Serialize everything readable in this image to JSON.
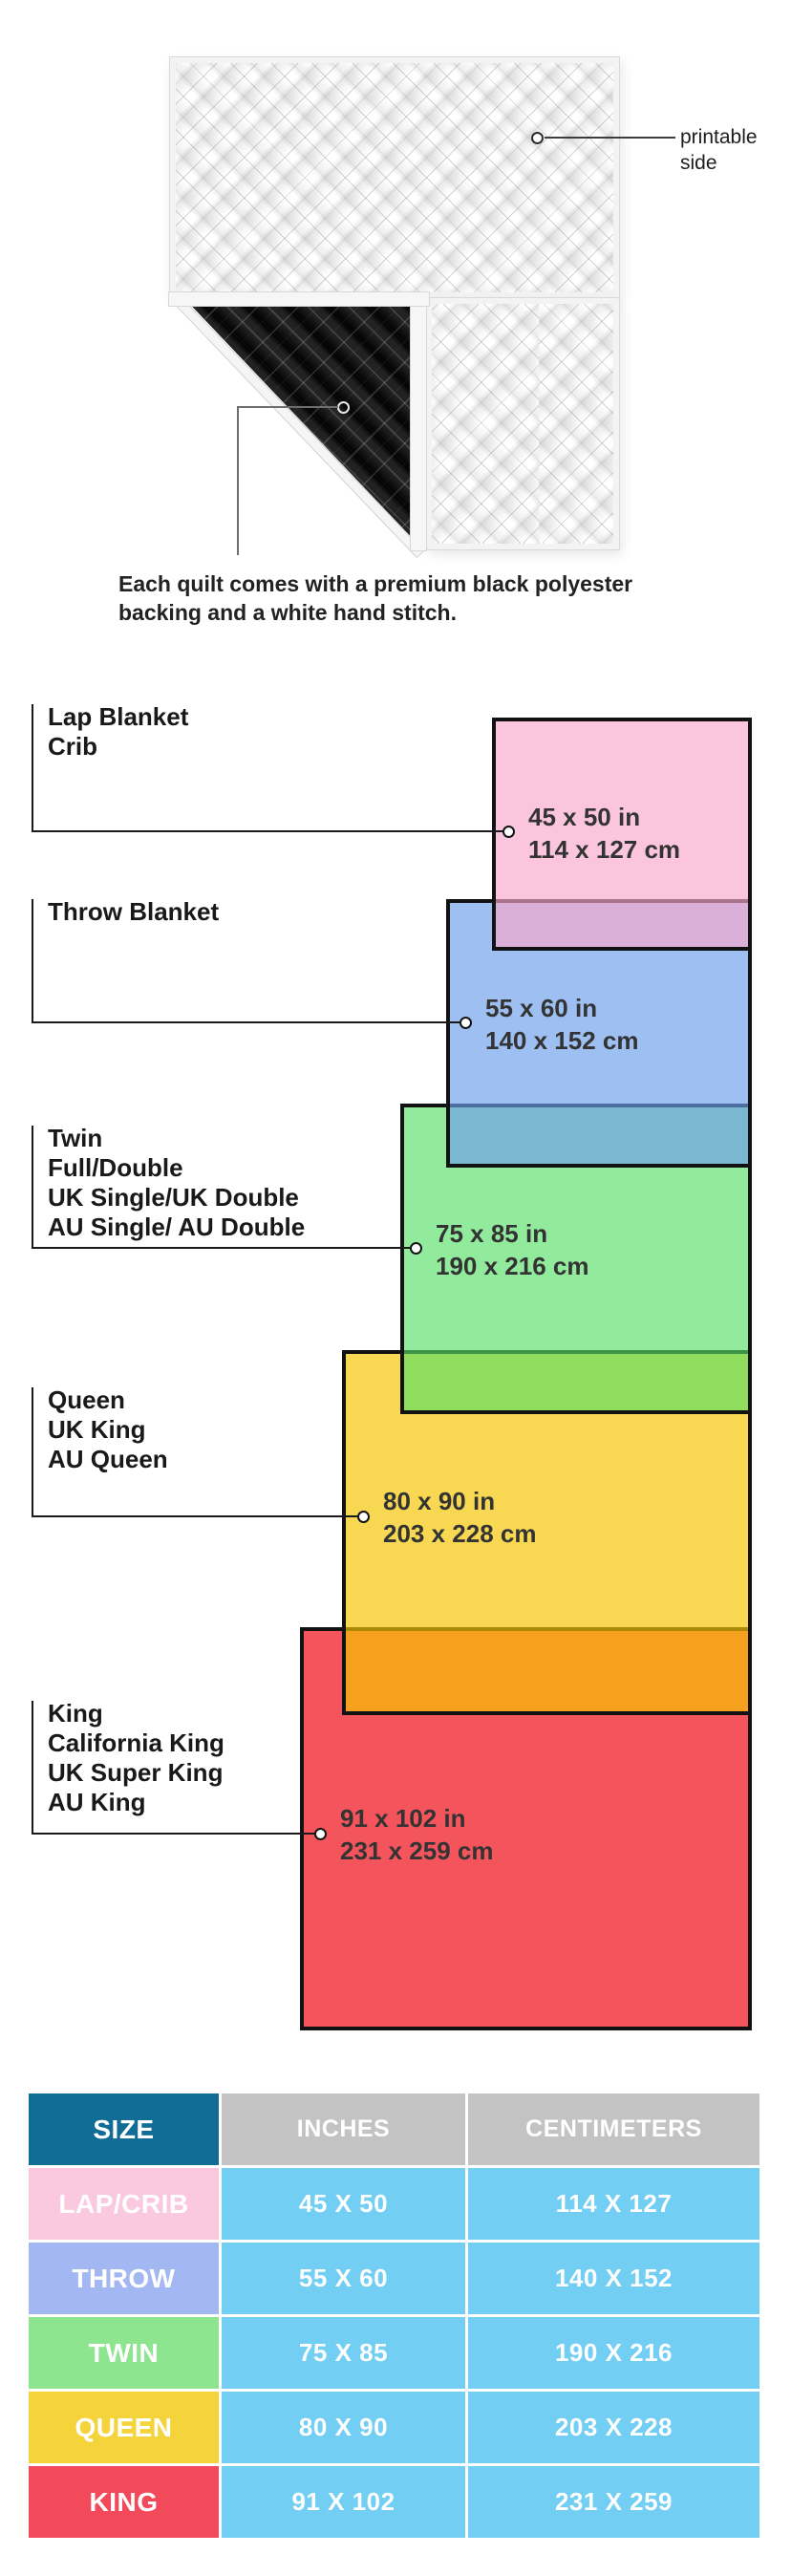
{
  "hero": {
    "printable_annotation": {
      "line1": "printable",
      "line2": "side"
    },
    "caption": {
      "line1": "Each quilt comes with a premium black polyester",
      "line2": "backing and a white hand stitch."
    },
    "front_color": "#ffffff",
    "backing_color": "#161616"
  },
  "diagram": {
    "entries": [
      {
        "names": [
          "Lap Blanket",
          "Crib"
        ],
        "inches": "45 x 50 in",
        "cm": "114 x 127 cm",
        "fill": "rgba(249,168,203,0.66)"
      },
      {
        "names": [
          "Throw Blanket"
        ],
        "inches": "55 x 60 in",
        "cm": "140 x 152 cm",
        "fill": "rgba(108,158,235,0.66)"
      },
      {
        "names": [
          "Twin",
          "Full/Double",
          "UK Single/UK Double",
          "AU Single/ AU Double"
        ],
        "inches": "75 x 85 in",
        "cm": "190 x 216 cm",
        "fill": "rgba(85,223,100,0.64)"
      },
      {
        "names": [
          "Queen",
          "UK King",
          "AU Queen"
        ],
        "inches": "80 x 90 in",
        "cm": "203 x 228 cm",
        "fill": "rgba(244,198,0,0.68)"
      },
      {
        "names": [
          "King",
          "California King",
          "UK Super King",
          "AU King"
        ],
        "inches": "91 x 102 in",
        "cm": "231 x 259 cm",
        "fill": "rgba(238,0,12,0.67)"
      }
    ],
    "border_color": "#121212"
  },
  "table": {
    "headers": {
      "size": "SIZE",
      "inches": "INCHES",
      "cm": "CENTIMETERS"
    },
    "header_colors": {
      "size_bg": "#116d96",
      "other_bg": "#c3c3c3"
    },
    "cell_bg": "#72cef3",
    "rows": [
      {
        "size": "LAP/CRIB",
        "inches": "45 X 50",
        "cm": "114 X 127",
        "color": "#fbc9df"
      },
      {
        "size": "THROW",
        "inches": "55 X 60",
        "cm": "140 X 152",
        "color": "#a3b8f2"
      },
      {
        "size": "TWIN",
        "inches": "75 X 85",
        "cm": "190 X 216",
        "color": "#8de68f"
      },
      {
        "size": "QUEEN",
        "inches": "80 X 90",
        "cm": "203 X 228",
        "color": "#f4d43a"
      },
      {
        "size": "KING",
        "inches": "91 X 102",
        "cm": "231 X 259",
        "color": "#f2495b"
      }
    ]
  }
}
